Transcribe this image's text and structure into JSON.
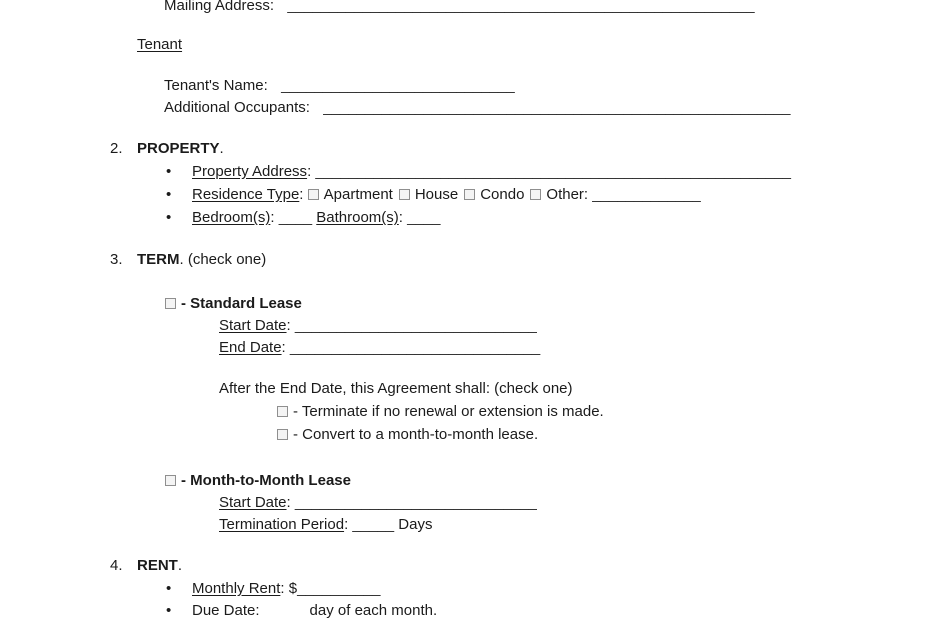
{
  "icons": {
    "bullet": "•",
    "checkbox": "empty-checkbox-square"
  },
  "doc": {
    "colon": ":",
    "landlord": {
      "mailing_label": "Mailing Address:",
      "mailing_blank": "________________________________________________________"
    },
    "tenant": {
      "heading": "Tenant",
      "name_label": "Tenant's Name:",
      "name_blank": "____________________________",
      "occupants_label": "Additional Occupants:",
      "occupants_blank": "________________________________________________________"
    },
    "property": {
      "number": "2.",
      "title": "PROPERTY",
      "period": ".",
      "address_label": "Property Address",
      "address_blank": "_________________________________________________________",
      "residence_label": "Residence Type",
      "opt_apartment": "Apartment",
      "opt_house": "House",
      "opt_condo": "Condo",
      "opt_other": "Other",
      "other_blank": "_____________",
      "bedroom_label": "Bedroom(s)",
      "bedroom_blank": "____",
      "bathroom_label": "Bathroom(s)",
      "bathroom_blank": "____"
    },
    "term": {
      "number": "3.",
      "title": "TERM",
      "period": ".",
      "note": "(check one)",
      "standard_label": "- Standard Lease",
      "standard_start_label": "Start Date",
      "standard_start_blank": "_____________________________",
      "standard_end_label": "End Date",
      "standard_end_blank": "______________________________",
      "after_note": "After the End Date, this Agreement shall: (check one)",
      "opt_terminate": "- Terminate if no renewal or extension is made.",
      "opt_convert": "- Convert to a month-to-month lease.",
      "m2m_label": "- Month-to-Month Lease",
      "m2m_start_label": "Start Date",
      "m2m_start_blank": "_____________________________",
      "termination_label": "Termination Period",
      "termination_blank": "_____",
      "termination_suffix": "Days"
    },
    "rent": {
      "number": "4.",
      "title": "RENT",
      "period": ".",
      "monthly_label": "Monthly Rent",
      "monthly_currency": "$",
      "monthly_blank": "__________",
      "due_label": "Due Date:",
      "due_suffix": "day of each month."
    }
  }
}
